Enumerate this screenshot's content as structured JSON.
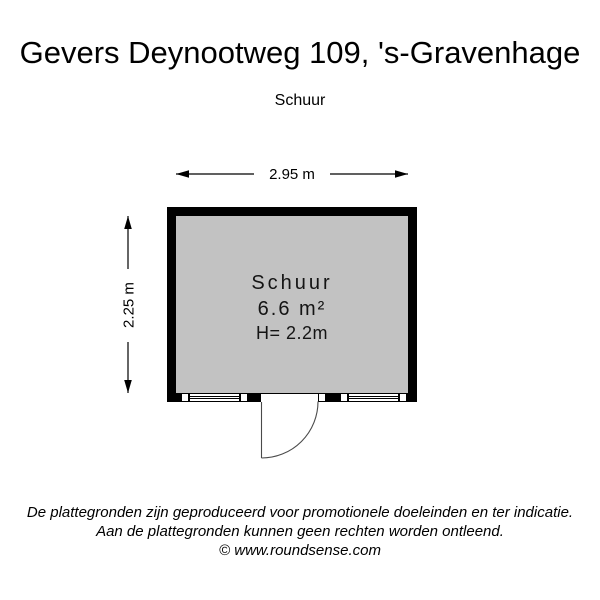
{
  "header": {
    "title": "Gevers Deynootweg 109, 's-Gravenhage",
    "subtitle": "Schuur"
  },
  "plan": {
    "dimensions": {
      "width_label": "2.95 m",
      "height_label": "2.25 m"
    },
    "room": {
      "name": "Schuur",
      "area": "6.6 m²",
      "ceiling_height": "H= 2.2m"
    },
    "colors": {
      "wall": "#000000",
      "floor": "#c2c2c2",
      "background": "#ffffff"
    }
  },
  "footer": {
    "disclaimer_line1": "De plattegronden zijn geproduceerd voor promotionele doeleinden en ter indicatie.",
    "disclaimer_line2": "Aan de plattegronden kunnen geen rechten worden ontleend.",
    "copyright": "© www.roundsense.com"
  }
}
